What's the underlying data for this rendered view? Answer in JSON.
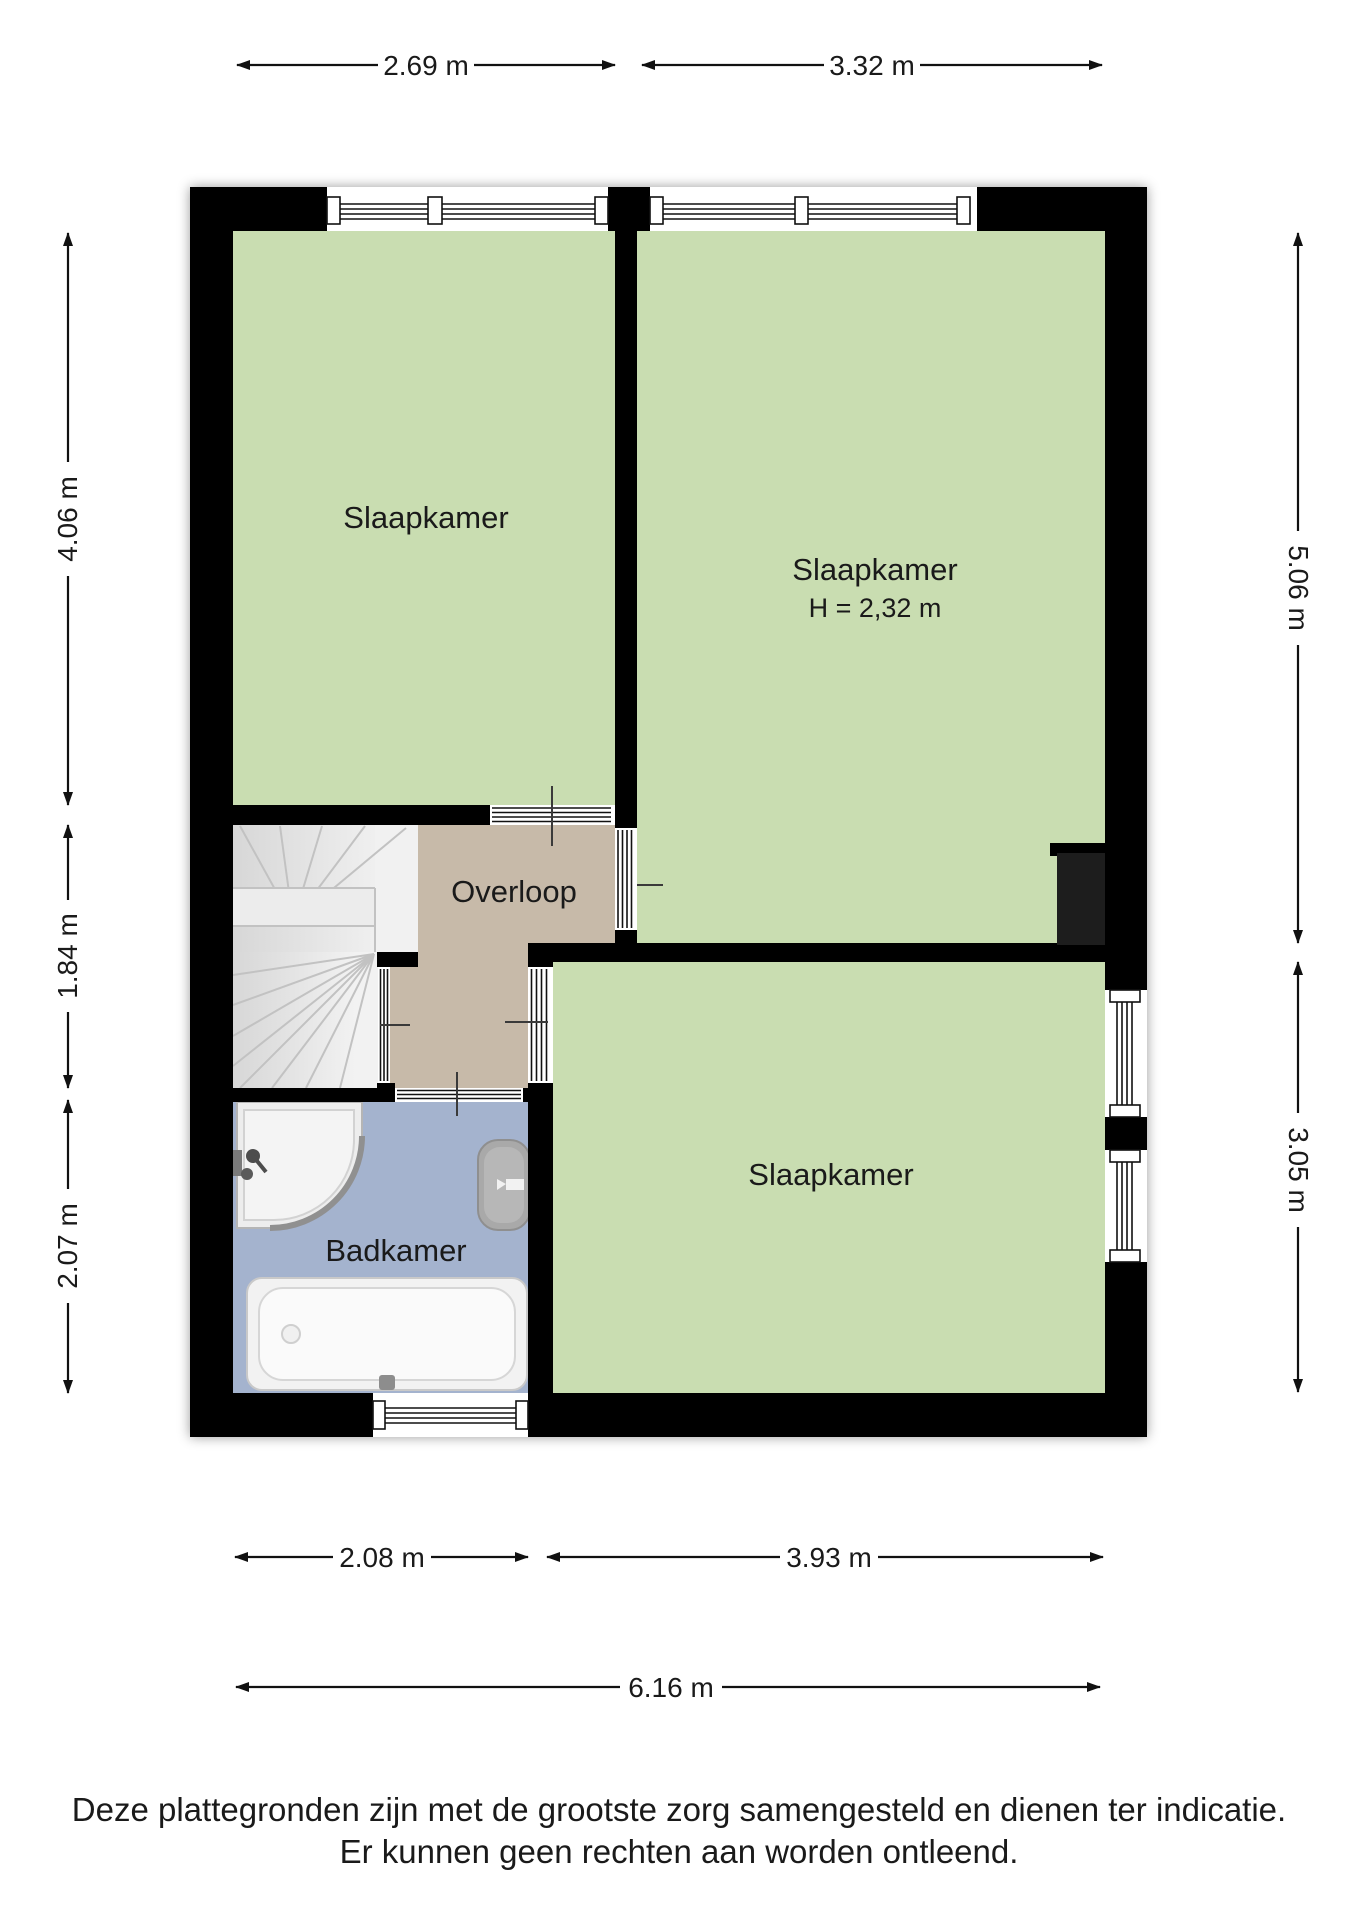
{
  "rooms": {
    "bedroom_top_left": {
      "label": "Slaapkamer"
    },
    "bedroom_top_right": {
      "label": "Slaapkamer",
      "ceiling_height": "H = 2,32 m"
    },
    "bedroom_bottom": {
      "label": "Slaapkamer"
    },
    "landing": {
      "label": "Overloop"
    },
    "bathroom": {
      "label": "Badkamer"
    }
  },
  "dimensions": {
    "top": [
      "2.69 m",
      "3.32 m"
    ],
    "left": [
      "4.06 m",
      "1.84 m",
      "2.07 m"
    ],
    "right": [
      "5.06 m",
      "3.05 m"
    ],
    "bottom": [
      "2.08 m",
      "3.93 m",
      "6.16 m"
    ]
  },
  "footer": {
    "line1": "Deze plattegronden zijn met de grootste zorg samengesteld en dienen ter indicatie.",
    "line2": "Er kunnen geen rechten aan worden ontleend."
  },
  "colors": {
    "wall": "#000000",
    "bedroom_floor": "#c9ddb1",
    "landing_floor": "#c7baa9",
    "bathroom_floor": "#a4b3ce",
    "stairs": "#ededed",
    "dimension_text": "#1a1a1a"
  }
}
